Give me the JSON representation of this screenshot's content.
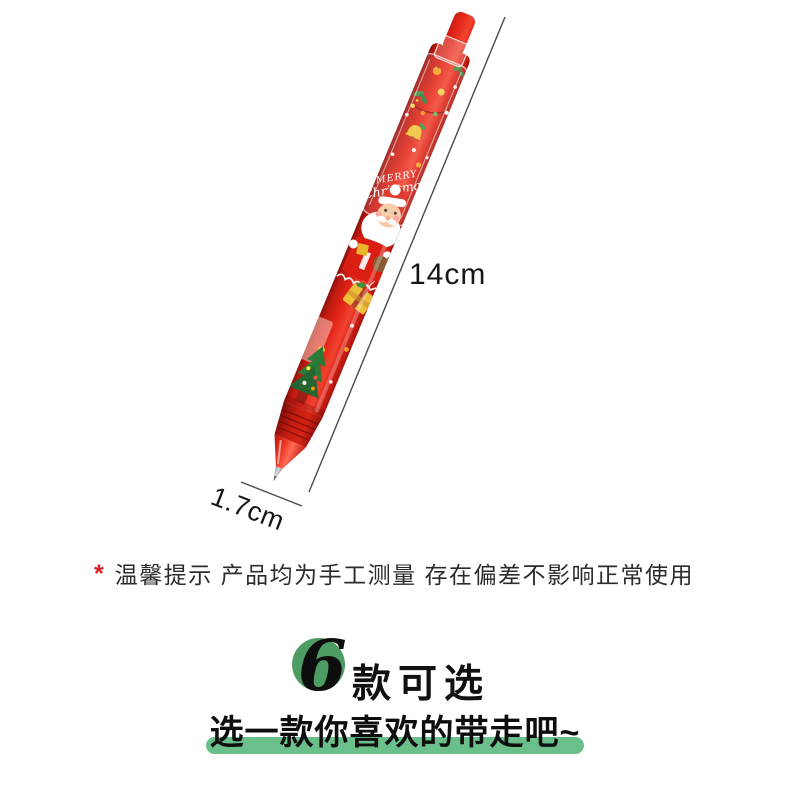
{
  "pen": {
    "description": "red christmas push pen with santa print",
    "print_line1": "MERRY",
    "print_line2": "Christmas"
  },
  "dimensions": {
    "length": "14cm",
    "diameter": "1.7cm"
  },
  "notice": {
    "marker": "*",
    "text": "温馨提示 产品均为手工测量 存在偏差不影响正常使用"
  },
  "promo": {
    "count": "6",
    "suffix": "款可选",
    "subtitle": "选一款你喜欢的带走吧~"
  },
  "colors": {
    "barrel_red": "#e2261a",
    "circle_green": "#4d9c64",
    "highlight_green": "#6abf8a",
    "dimension_line_gray": "#4a4a4a",
    "notice_star_red": "#e01e1e",
    "text_dark": "#161616"
  }
}
